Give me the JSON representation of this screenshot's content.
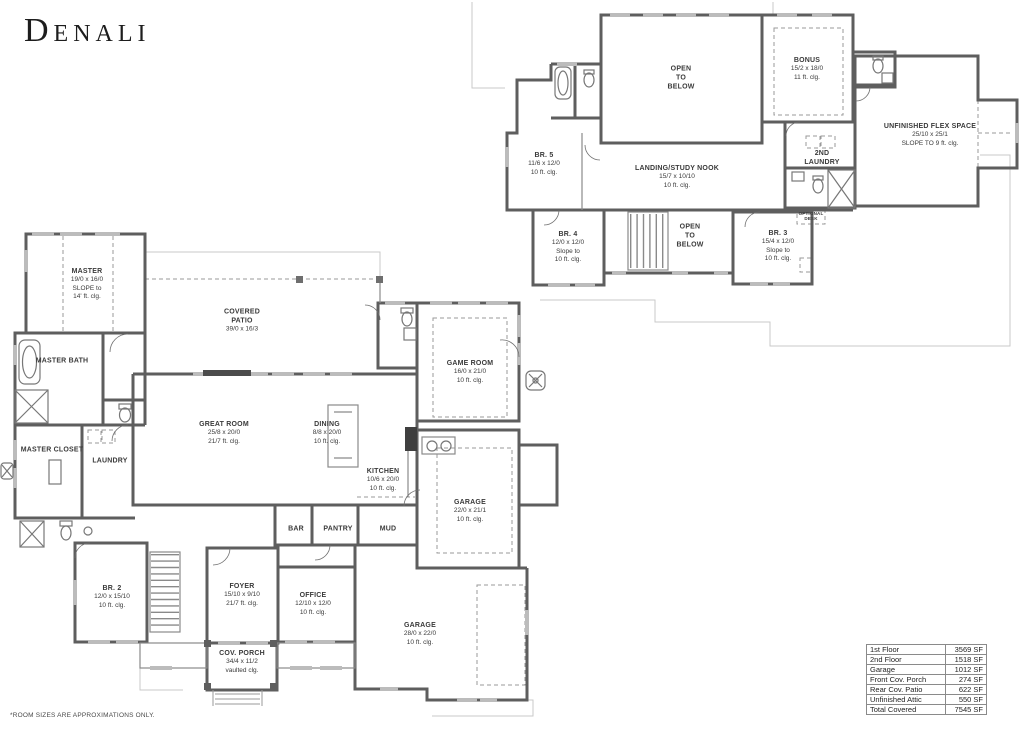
{
  "title": "Denali",
  "footnote": "*ROOM SIZES ARE APPROXIMATIONS ONLY.",
  "colors": {
    "wall": "#5e5e5e",
    "window": "#b9b9b9",
    "outline": "#c9c9c9",
    "text": "#3a3a3a"
  },
  "floor1": {
    "rooms": {
      "master": {
        "l1": "MASTER",
        "l2": "19/0 x 16/0",
        "l3": "SLOPE to",
        "l4": "14' ft. clg."
      },
      "master_bath": {
        "l1": "MASTER BATH"
      },
      "master_closet": {
        "l1": "MASTER CLOSET"
      },
      "laundry": {
        "l1": "LAUNDRY"
      },
      "covered_patio": {
        "l1": "COVERED",
        "l2": "PATIO",
        "l3": "39/0 x 16/3"
      },
      "great_room": {
        "l1": "GREAT ROOM",
        "l2": "25/8 x 20/0",
        "l3": "21/7 ft. clg."
      },
      "dining": {
        "l1": "DINING",
        "l2": "8/8 x 20/0",
        "l3": "10 ft. clg."
      },
      "kitchen": {
        "l1": "KITCHEN",
        "l2": "10/6 x 20/0",
        "l3": "10 ft. clg."
      },
      "game_room": {
        "l1": "GAME ROOM",
        "l2": "16/0 x 21/0",
        "l3": "10 ft. clg."
      },
      "garage_side": {
        "l1": "GARAGE",
        "l2": "22/0 x 21/1",
        "l3": "10 ft. clg."
      },
      "garage_rear": {
        "l1": "GARAGE",
        "l2": "28/0 x 22/0",
        "l3": "10 ft. clg."
      },
      "bar": {
        "l1": "BAR"
      },
      "pantry": {
        "l1": "PANTRY"
      },
      "mud": {
        "l1": "MUD"
      },
      "br2": {
        "l1": "BR. 2",
        "l2": "12/0 x 15/10",
        "l3": "10 ft. clg."
      },
      "foyer": {
        "l1": "FOYER",
        "l2": "15/10 x 9/10",
        "l3": "21/7 ft. clg."
      },
      "office": {
        "l1": "OFFICE",
        "l2": "12/10 x 12/0",
        "l3": "10 ft. clg."
      },
      "cov_porch": {
        "l1": "COV. PORCH",
        "l2": "34/4 x 11/2",
        "l3": "vaulted clg."
      }
    }
  },
  "floor2": {
    "rooms": {
      "open_to_below_upper": {
        "l1": "OPEN",
        "l2": "TO",
        "l3": "BELOW"
      },
      "bonus": {
        "l1": "BONUS",
        "l2": "15/2 x 18/0",
        "l3": "11 ft. clg."
      },
      "flex": {
        "l1": "UNFINISHED FLEX SPACE",
        "l2": "25/10 x 25/1",
        "l3": "SLOPE TO 9 ft. clg."
      },
      "br5": {
        "l1": "BR. 5",
        "l2": "11/6 x 12/0",
        "l3": "10 ft. clg."
      },
      "landing": {
        "l1": "LANDING/STUDY NOOK",
        "l2": "15/7 x 10/10",
        "l3": "10 ft. clg."
      },
      "laundry2": {
        "l1": "2ND",
        "l2": "LAUNDRY"
      },
      "br4": {
        "l1": "BR. 4",
        "l2": "12/0 x 12/0",
        "l3": "Slope to",
        "l4": "10 ft. clg."
      },
      "open_to_below_lower": {
        "l1": "OPEN",
        "l2": "TO",
        "l3": "BELOW"
      },
      "br3": {
        "l1": "BR. 3",
        "l2": "15/4 x 12/0",
        "l3": "Slope to",
        "l4": "10 ft. clg."
      },
      "optional_desk": {
        "l1": "OPTIONAL",
        "l2": "DESK"
      }
    }
  },
  "area_table": {
    "rows": [
      {
        "label": "1st Floor",
        "value": "3569 SF"
      },
      {
        "label": "2nd Floor",
        "value": "1518 SF"
      },
      {
        "label": "Garage",
        "value": "1012 SF"
      },
      {
        "label": "Front Cov. Porch",
        "value": "274 SF"
      },
      {
        "label": "Rear Cov. Patio",
        "value": "622 SF"
      },
      {
        "label": "Unfinished Attic",
        "value": "550 SF"
      },
      {
        "label": "Total Covered",
        "value": "7545 SF"
      }
    ]
  }
}
